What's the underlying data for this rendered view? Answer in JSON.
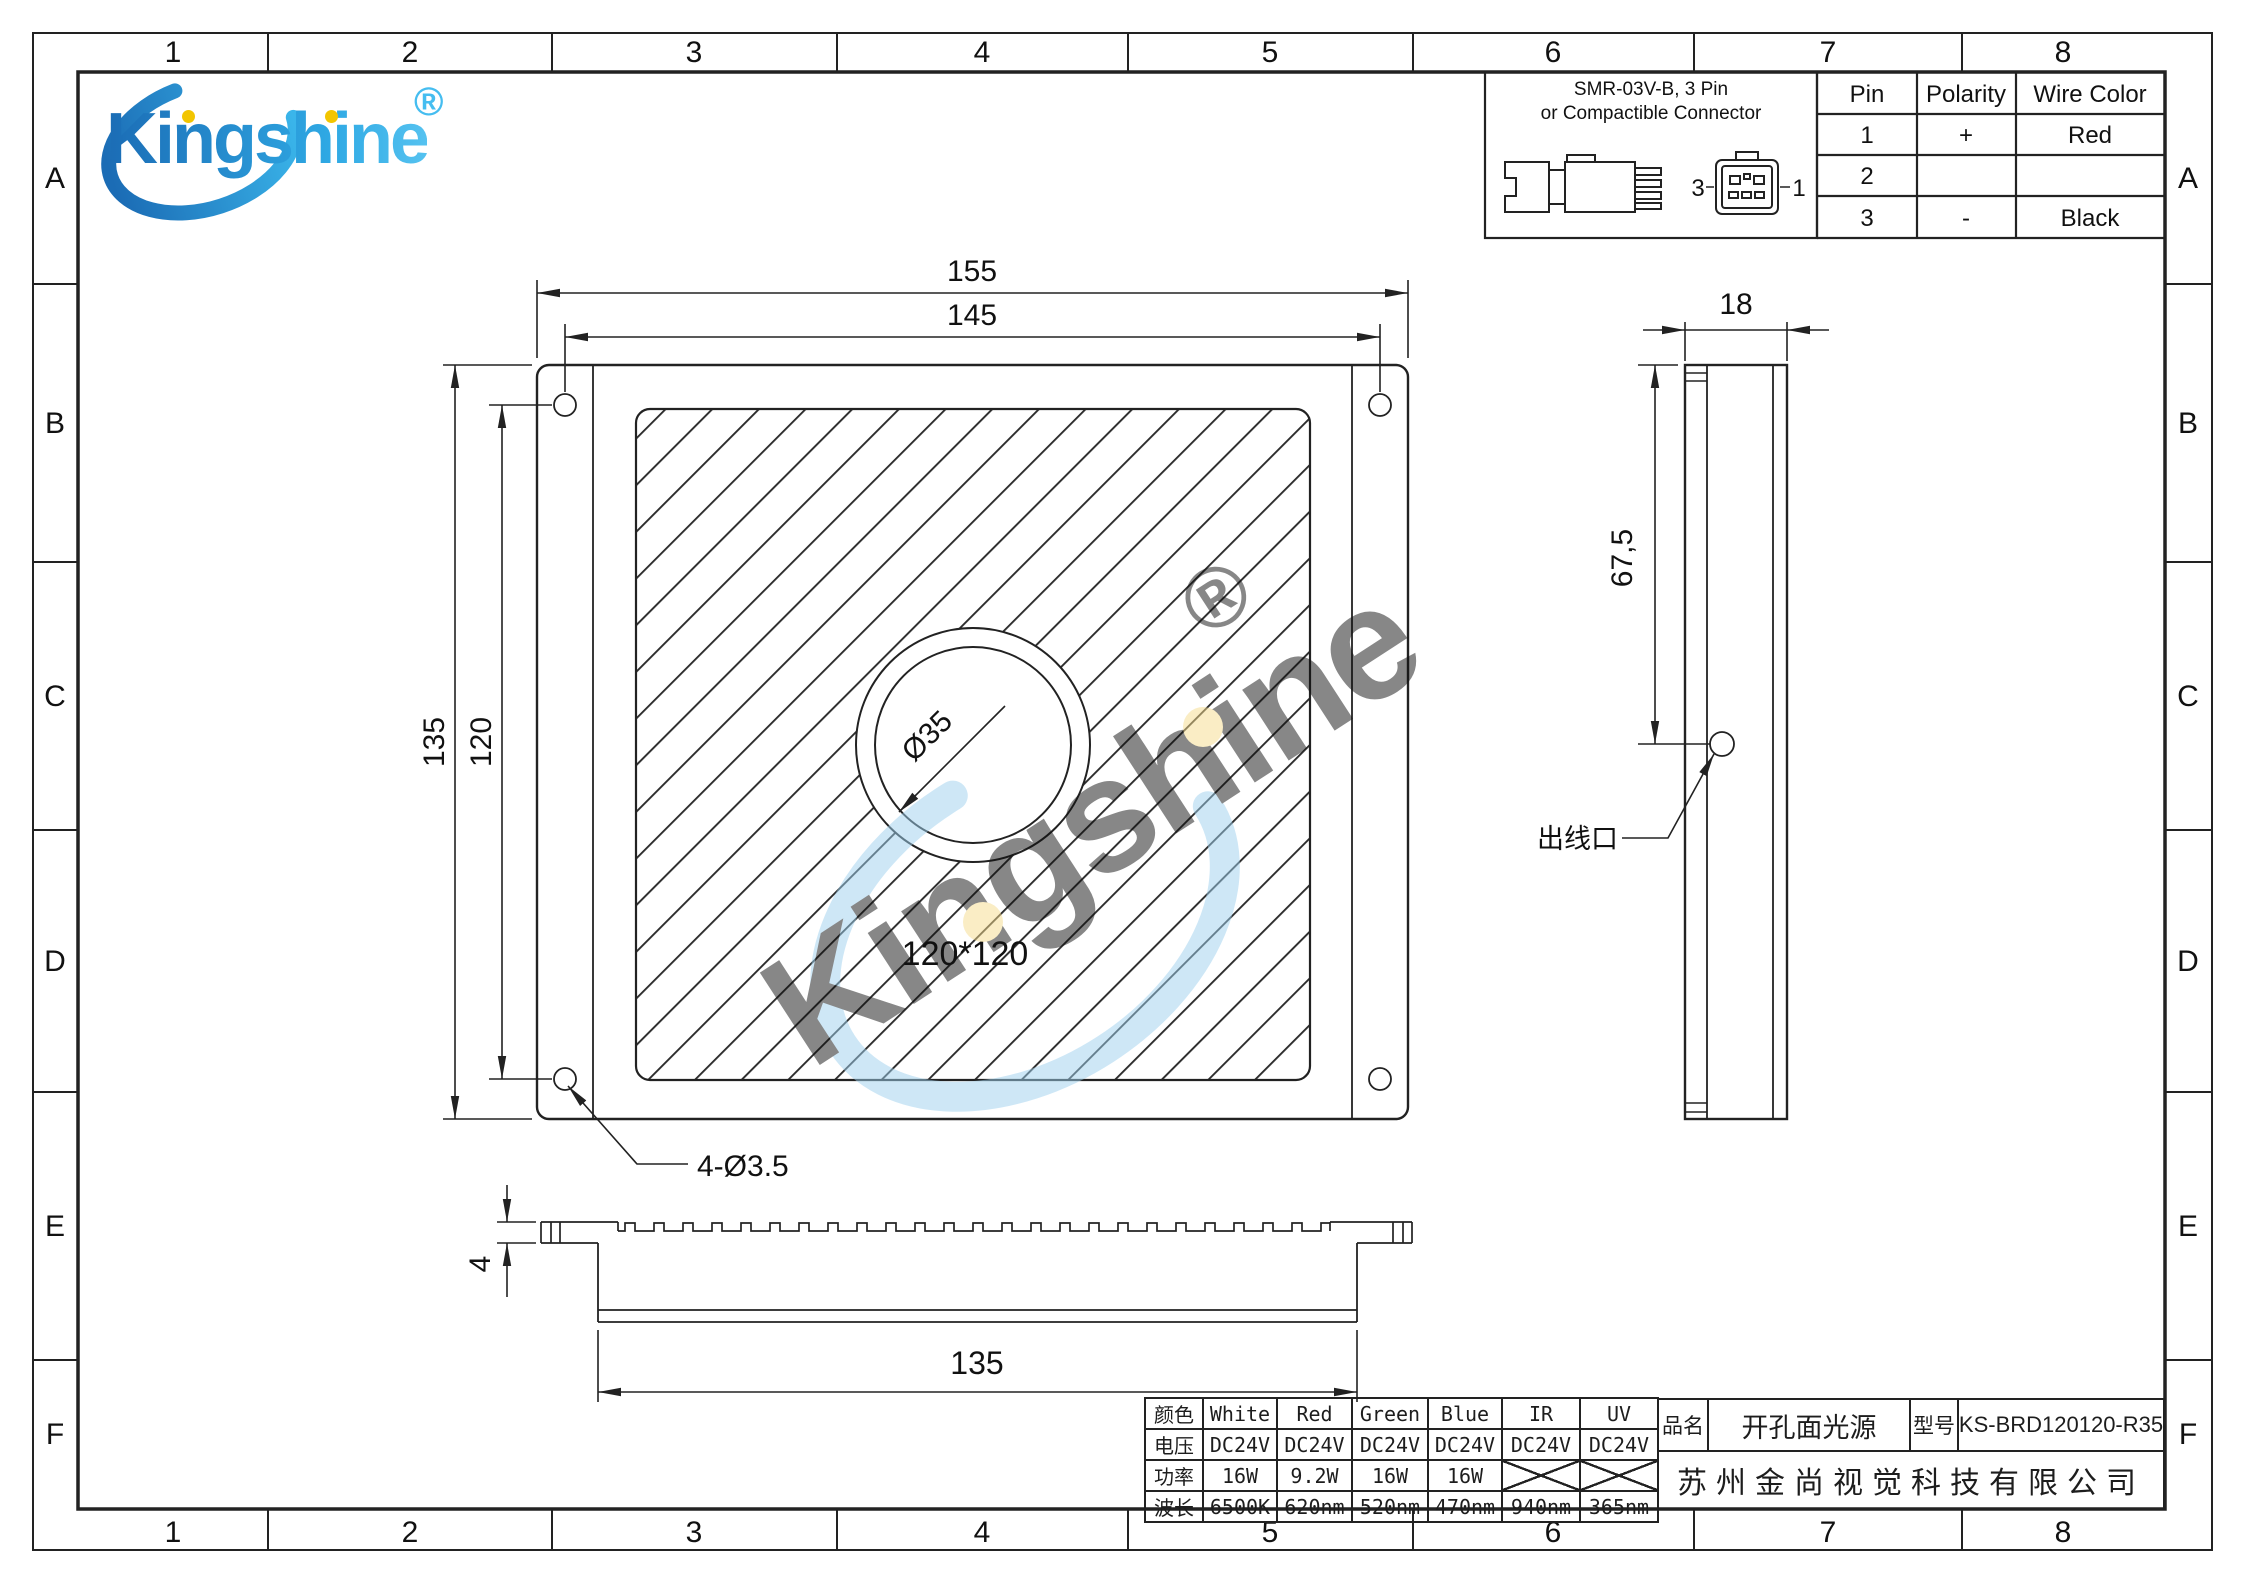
{
  "grid": {
    "columns": [
      "1",
      "2",
      "3",
      "4",
      "5",
      "6",
      "7",
      "8"
    ],
    "rows": [
      "A",
      "B",
      "C",
      "D",
      "E",
      "F"
    ]
  },
  "logo": {
    "brand": "Kingshine",
    "registered": "®"
  },
  "watermark": {
    "text": "Kingshine",
    "registered": "®"
  },
  "connector": {
    "title_line1": "SMR-03V-B, 3 Pin",
    "title_line2": "or Compactible Connector",
    "label_left": "3",
    "label_right": "1"
  },
  "pin_table": {
    "headers": [
      "Pin",
      "Polarity",
      "Wire Color"
    ],
    "rows": [
      [
        "1",
        "+",
        "Red"
      ],
      [
        "2",
        "",
        ""
      ],
      [
        "3",
        "-",
        "Black"
      ]
    ]
  },
  "front_view": {
    "dim_overall_width": "155",
    "dim_hole_span_h": "145",
    "dim_overall_height": "135",
    "dim_hole_span_v": "120",
    "dim_center_hole": "Ø35",
    "luminous_area": "120*120",
    "dim_mount_holes": "4-Ø3.5"
  },
  "side_view": {
    "dim_depth": "18",
    "dim_outlet_pos": "67,5",
    "outlet_label": "出线口"
  },
  "bottom_view": {
    "dim_flange_thickness": "4",
    "dim_body_width": "135"
  },
  "spec_table": {
    "rows": [
      [
        "颜色",
        "White",
        "Red",
        "Green",
        "Blue",
        "IR",
        "UV"
      ],
      [
        "电压",
        "DC24V",
        "DC24V",
        "DC24V",
        "DC24V",
        "DC24V",
        "DC24V"
      ],
      [
        "功率",
        "16W",
        "9.2W",
        "16W",
        "16W",
        "",
        ""
      ],
      [
        "波长",
        "6500K",
        "620nm",
        "520nm",
        "470nm",
        "940nm",
        "365nm"
      ]
    ]
  },
  "title_block": {
    "name_label": "品名",
    "name_value": "开孔面光源",
    "model_label": "型号",
    "model_value": "KS-BRD120120-R35",
    "company": "苏州金尚视觉科技有限公司"
  },
  "colors": {
    "line": "#222222",
    "brand_blue_dark": "#1b6cb5",
    "brand_blue_light": "#2fa9e4",
    "watermark_blue": "#9ed1ef",
    "logo_dot_yellow": "#f2c500"
  }
}
